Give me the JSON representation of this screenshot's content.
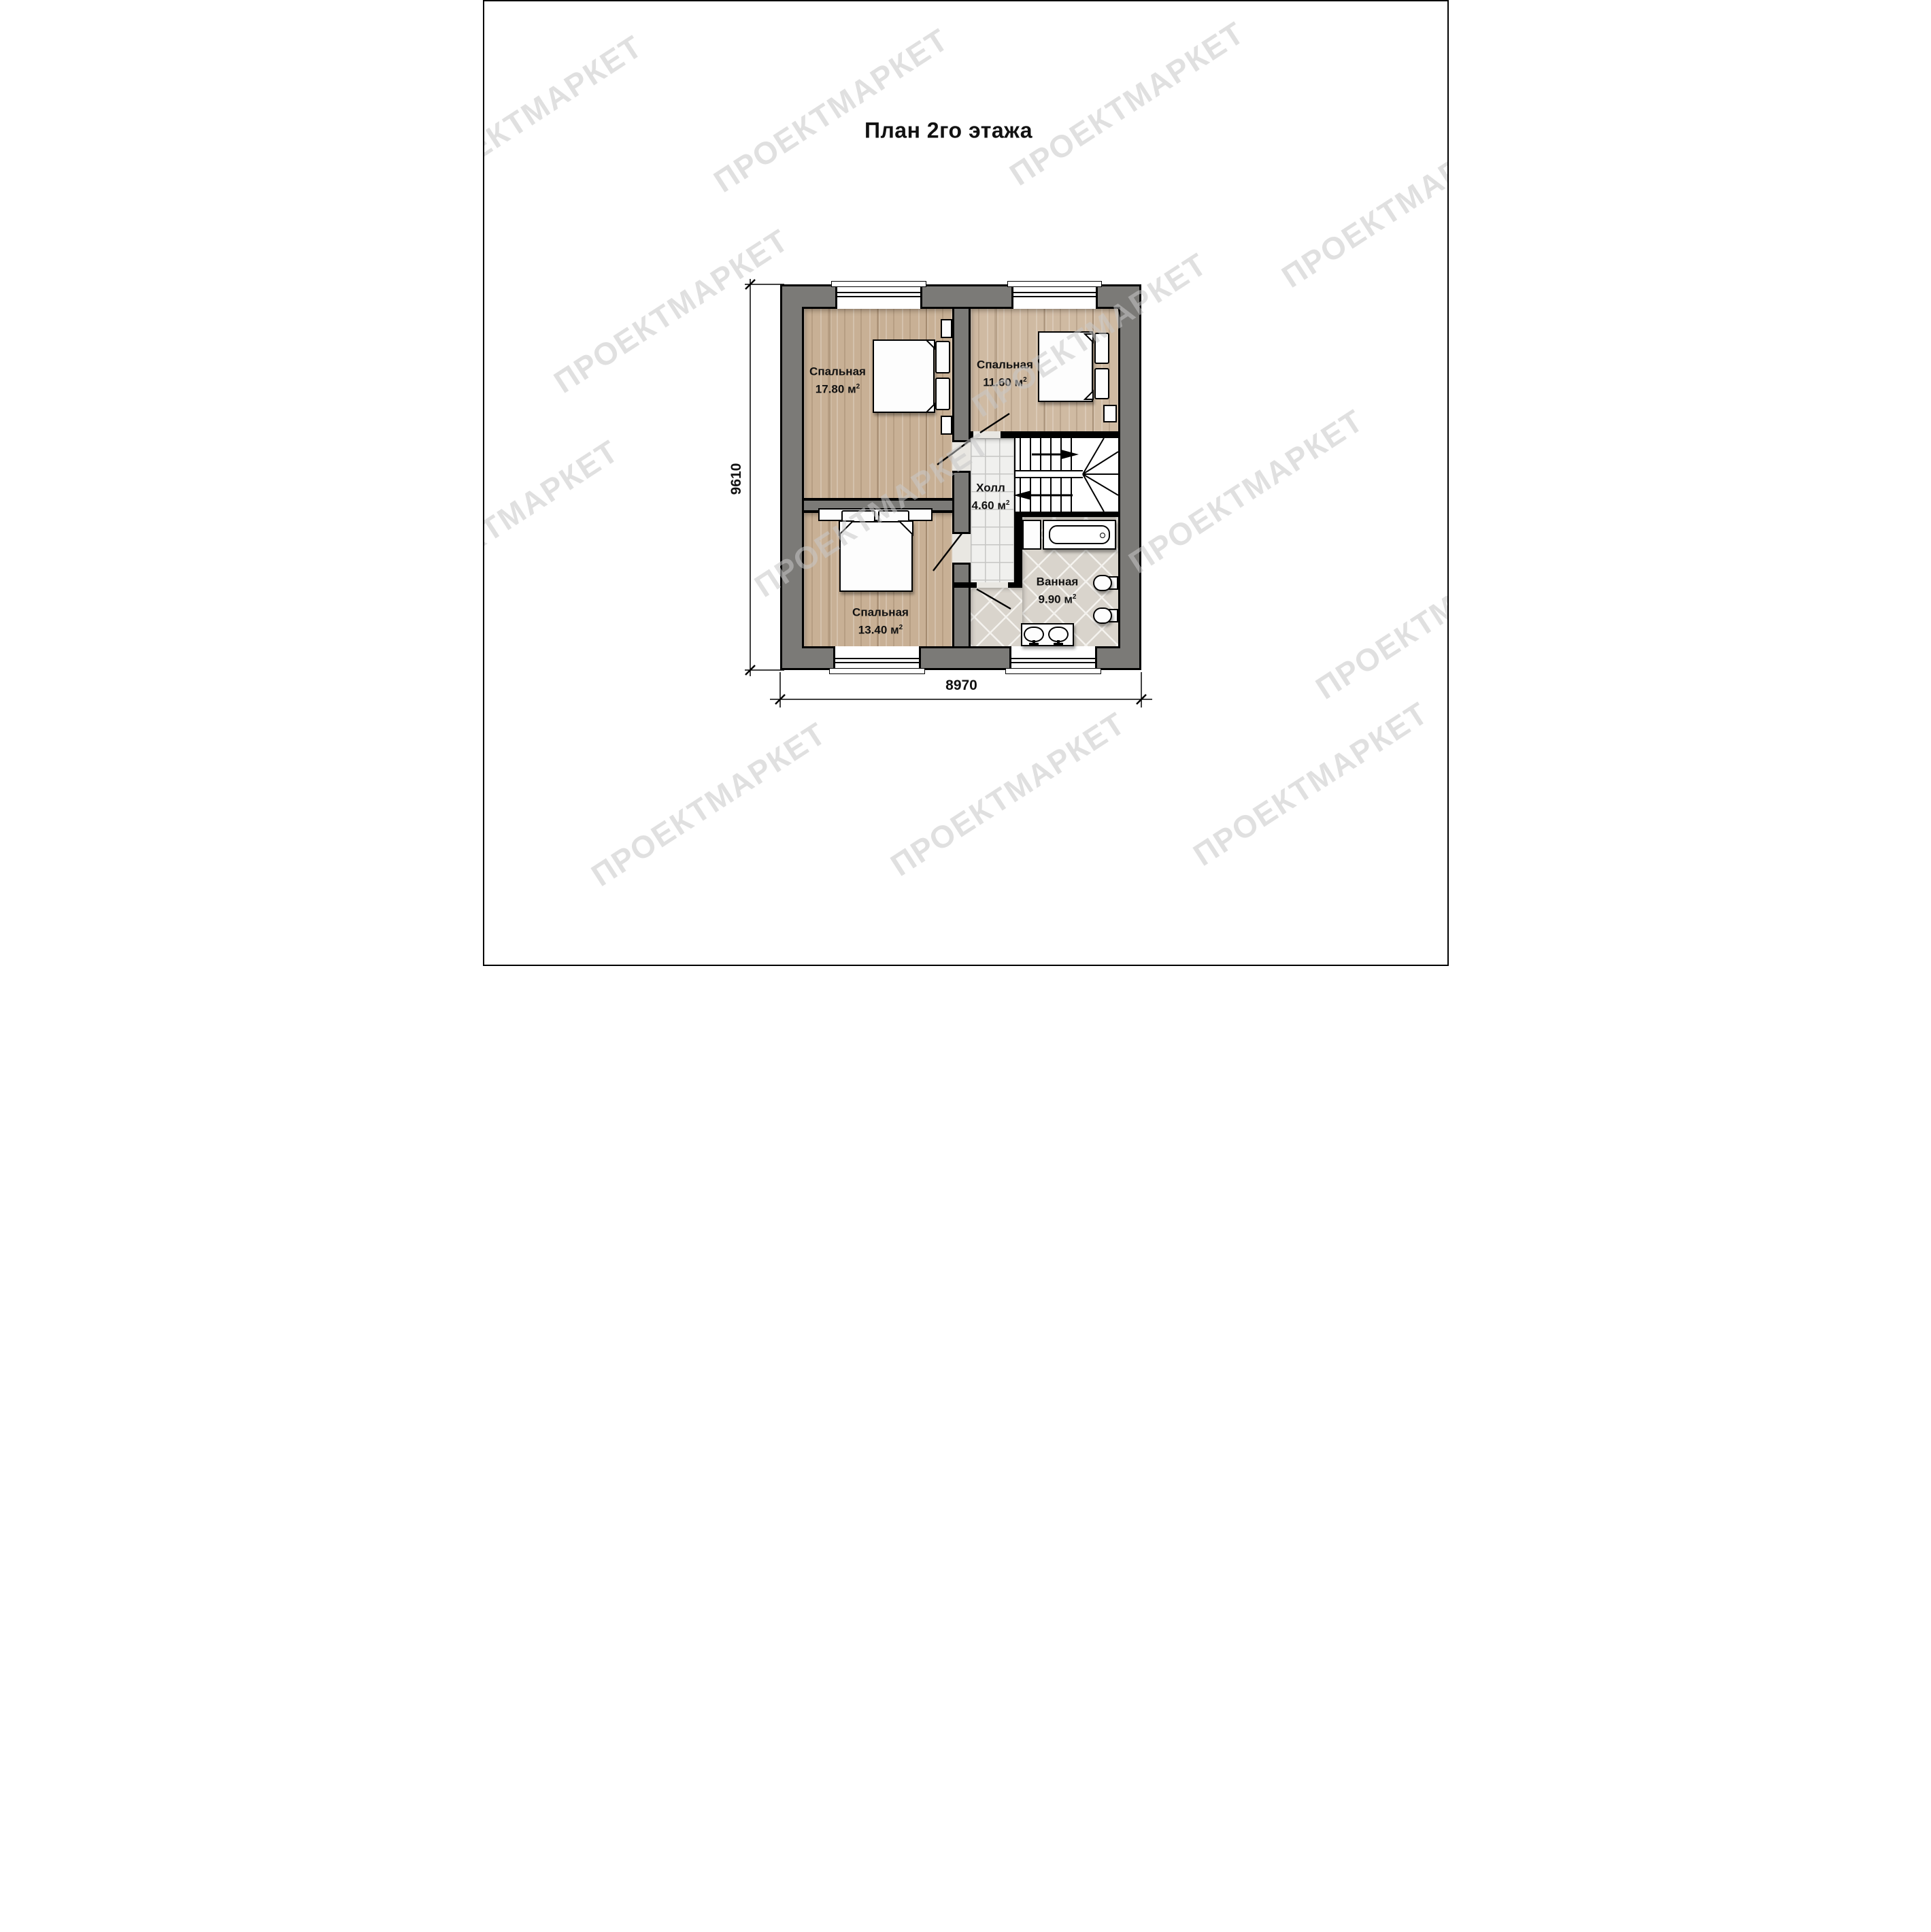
{
  "title": "План 2го этажа",
  "watermark": "ПРОЕКТМАРКЕТ",
  "rooms": {
    "bedroom_large": {
      "name": "Спальная",
      "area": "17.80",
      "unit": "м",
      "exp": "2"
    },
    "bedroom_right": {
      "name": "Спальная",
      "area": "11.60",
      "unit": "м",
      "exp": "2"
    },
    "bedroom_lower": {
      "name": "Спальная",
      "area": "13.40",
      "unit": "м",
      "exp": "2"
    },
    "hall": {
      "name": "Холл",
      "area": "4.60",
      "unit": "м",
      "exp": "2"
    },
    "bathroom": {
      "name": "Ванная",
      "area": "9.90",
      "unit": "м",
      "exp": "2"
    }
  },
  "dimensions": {
    "bottom": "8970",
    "left": "9610"
  },
  "colors": {
    "wall": "#7b7a77",
    "wood": "#c8b095",
    "wood-light": "#cfbaa2",
    "tile-hall": "#f0f0ee",
    "tile-grid": "#c6c6c4",
    "tile-bath": "#d9d4cc",
    "tile-bath-line": "#f4f2ee",
    "wm": "#c8c8c8"
  }
}
